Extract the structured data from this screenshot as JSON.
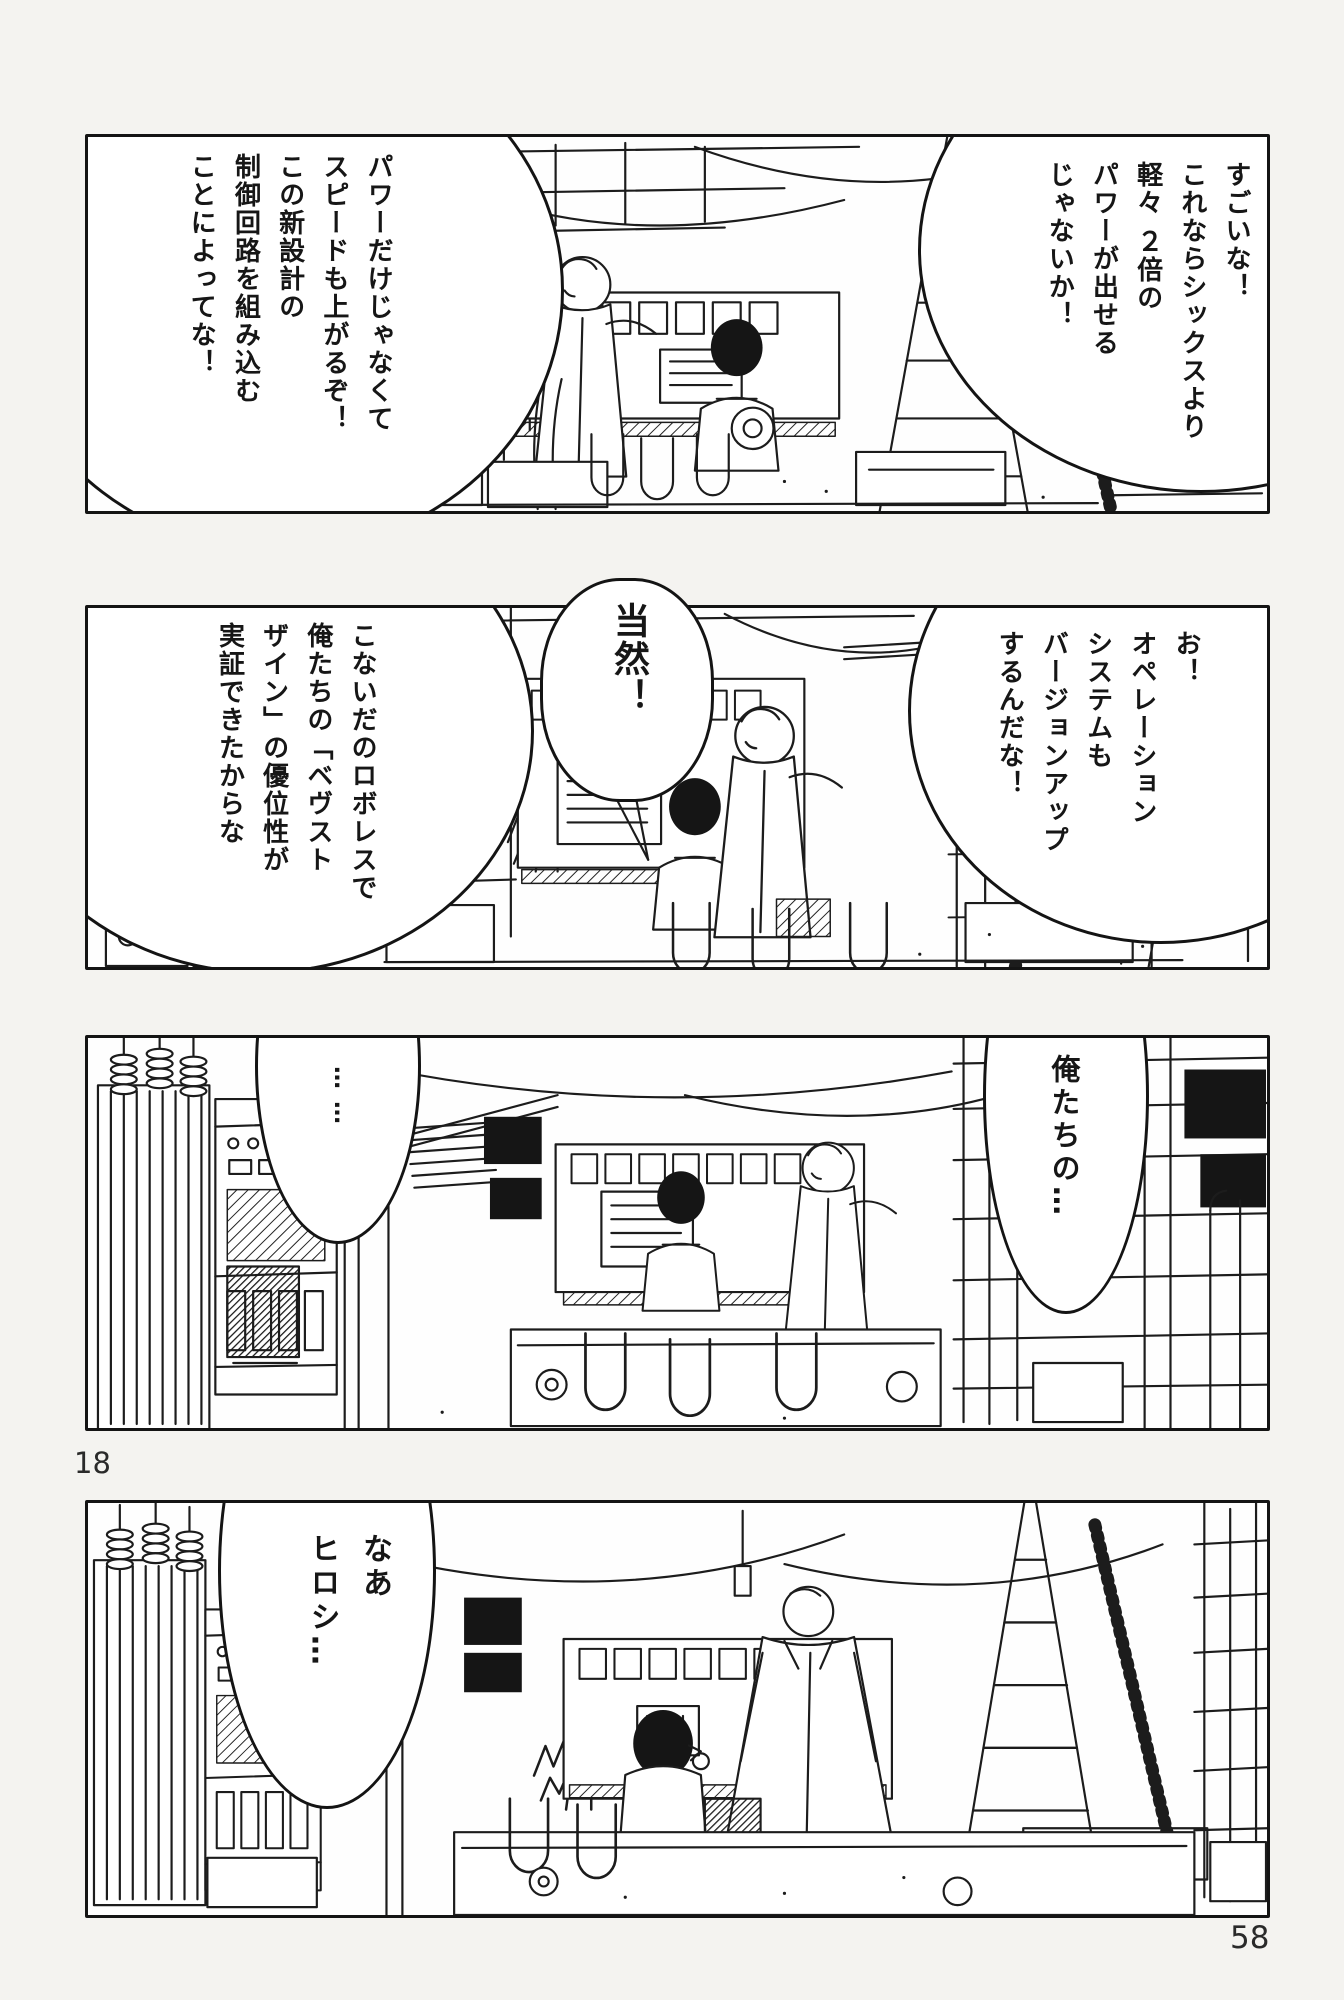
{
  "page": {
    "left_page_number": "18",
    "right_page_number": "58"
  },
  "panels": [
    {
      "name": "panel-1",
      "bubbles": {
        "right": {
          "text": "すごいな！\nこれならシックスより\n軽々 ２倍の\nパワーが出せる\nじゃないか！"
        },
        "left": {
          "text": "パワーだけじゃなくて\nスピードも上がるぞ！\nこの新設計の\n制御回路を組み込む\nことによってな！"
        }
      }
    },
    {
      "name": "panel-2",
      "bubbles": {
        "right": {
          "text": "お！\nオペレーション\nシステムも\nバージョンアップ\nするんだな！"
        },
        "center": {
          "text": "当然！"
        },
        "left": {
          "text": "こないだのロボレスで\n俺たちの「ベヴスト\nザイン」の優位性が\n実証できたからな"
        }
      }
    },
    {
      "name": "panel-3",
      "bubbles": {
        "left": {
          "text": "……"
        },
        "right": {
          "text": "俺たちの…"
        }
      }
    },
    {
      "name": "panel-4",
      "bubbles": {
        "left": {
          "text": "なあ\nヒロシ…"
        }
      }
    }
  ]
}
